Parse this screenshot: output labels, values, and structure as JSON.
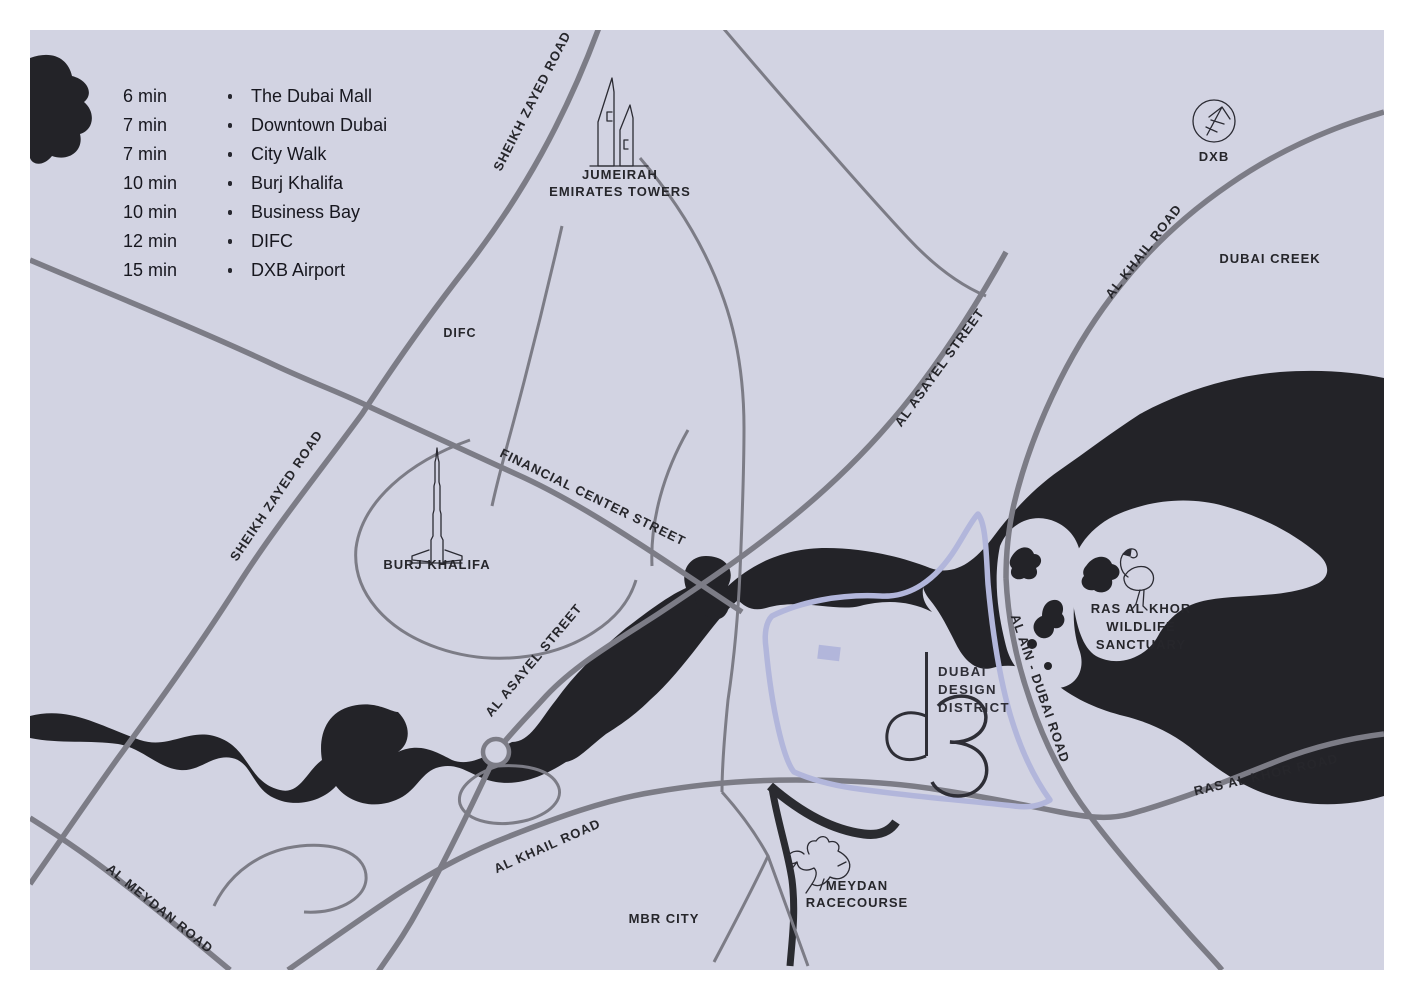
{
  "legend": {
    "items": [
      {
        "time": "6 min",
        "place": "The Dubai Mall"
      },
      {
        "time": "7 min",
        "place": "Downtown Dubai"
      },
      {
        "time": "7 min",
        "place": "City Walk"
      },
      {
        "time": "10 min",
        "place": "Burj Khalifa"
      },
      {
        "time": "10 min",
        "place": "Business Bay"
      },
      {
        "time": "12 min",
        "place": "DIFC"
      },
      {
        "time": "15 min",
        "place": "DXB Airport"
      }
    ]
  },
  "roads": {
    "sheikh_zayed_top": "SHEIKH ZAYED ROAD",
    "sheikh_zayed_left": "SHEIKH ZAYED ROAD",
    "financial_center": "FINANCIAL CENTER STREET",
    "al_asayel_upper": "AL ASAYEL STREET",
    "al_asayel_lower": "AL ASAYEL STREET",
    "al_khail_top": "AL KHAIL ROAD",
    "al_khail_bottom": "AL KHAIL ROAD",
    "ras_al_khor_road": "RAS AL KHOR ROAD",
    "al_ain_dubai": "AL AIN - DUBAI ROAD",
    "al_meydan": "AL MEYDAN ROAD"
  },
  "areas": {
    "difc": "DIFC",
    "dubai_creek": "DUBAI CREEK",
    "mbr_city": "MBR CITY"
  },
  "landmarks": {
    "jumeirah": {
      "line1": "JUMEIRAH",
      "line2": "EMIRATES TOWERS"
    },
    "dxb": {
      "label": "DXB"
    },
    "burj": {
      "label": "BURJ KHALIFA"
    },
    "ras_al_khor": {
      "line1": "RAS AL KHOR",
      "line2": "WILDLIFE",
      "line3": "SANCTUARY"
    },
    "meydan": {
      "line1": "MEYDAN",
      "line2": "RACECOURSE"
    },
    "d3": {
      "line1": "DUBAI",
      "line2": "DESIGN",
      "line3": "DISTRICT",
      "logo": "d3"
    }
  },
  "colors": {
    "background": "#ffffff",
    "map_fill": "#d2d3e2",
    "road": "#7c7c86",
    "water": "#232328",
    "d3_outline": "#b2b6db",
    "text": "#26262b"
  }
}
